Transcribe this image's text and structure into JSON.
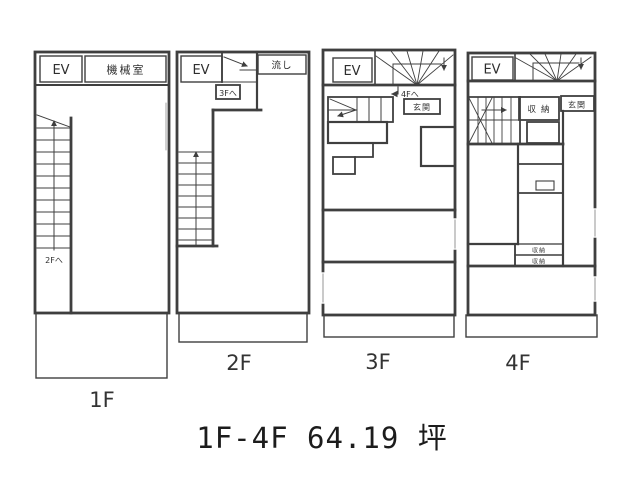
{
  "caption": "1F-4F 64.19 坪",
  "colors": {
    "line": "#3f3f3f",
    "background": "#ffffff"
  },
  "floors": {
    "f1": {
      "label": "1F",
      "ev": "EV",
      "machine_room": "機械室",
      "stair_note": "2Fへ"
    },
    "f2": {
      "label": "2F",
      "ev": "EV",
      "sink": "流し",
      "stair_note": "3Fへ"
    },
    "f3": {
      "label": "3F",
      "ev": "EV",
      "stair_note": "4Fへ",
      "entrance": "玄関"
    },
    "f4": {
      "label": "4F",
      "ev": "EV",
      "entrance": "玄関",
      "storage": "収納",
      "storage_small_1": "収納",
      "storage_small_2": "収納"
    }
  }
}
